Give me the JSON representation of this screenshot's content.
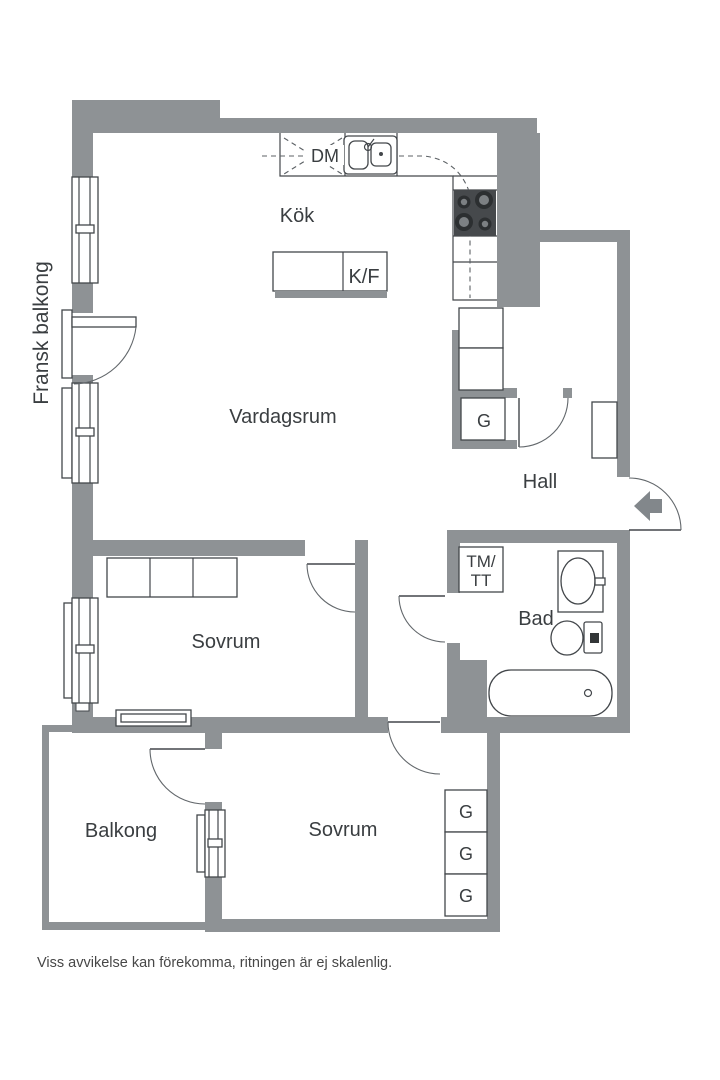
{
  "floor_plan": {
    "rooms": {
      "french_balcony": "Fransk balkong",
      "kitchen": "Kök",
      "living_room": "Vardagsrum",
      "hall": "Hall",
      "bathroom": "Bad",
      "bedroom_1": "Sovrum",
      "bedroom_2": "Sovrum",
      "balcony": "Balkong"
    },
    "labels": {
      "dishwasher": "DM",
      "fridge_freezer": "K/F",
      "hall_closet": "G",
      "washer_line1": "TM/",
      "washer_line2": "TT",
      "bedroom_closets": [
        "G",
        "G",
        "G"
      ]
    },
    "disclaimer": "Viss avvikelse kan förekomma, ritningen är ej skalenlig.",
    "colors": {
      "wall": "#8e9295",
      "fixture_line": "#43474b",
      "door_line": "#62676b",
      "text": "#3a3e41",
      "stove": "#46494c",
      "burner_ring": "#2c2f31",
      "burner_center": "#7c8083",
      "arrow": "#82878b",
      "background": "#ffffff"
    }
  }
}
